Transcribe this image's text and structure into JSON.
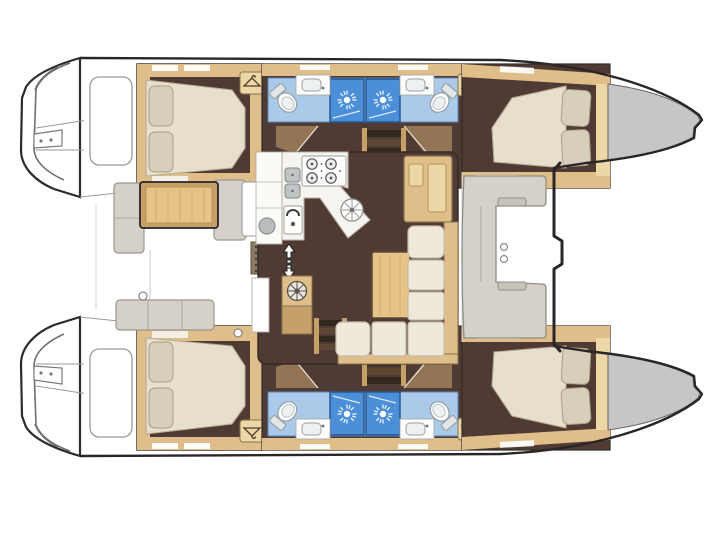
{
  "meta": {
    "title": "Catamaran sailing yacht interior layout floor plan, top-down view, bow to the right",
    "view": "top-down",
    "bow_direction": "right",
    "stern_direction": "left"
  },
  "colors": {
    "outline": "#2a2527",
    "hull_white": "#ffffff",
    "bow_deck_gray": "#c6c5c7",
    "cabin_floor_brown": "#4f3b33",
    "joinery_tan": "#dfbe8a",
    "joinery_light": "#ecd7a6",
    "joinery_dark": "#c5a068",
    "wood_table": "#e6c386",
    "upholstery_cream": "#efe9db",
    "mattress_cream": "#e7dfcc",
    "pillow_beige": "#d8cfba",
    "bathroom_floor_blue": "#abc9e8",
    "shower_blue": "#4b8fd8",
    "fixture_white": "#fdfdfb",
    "bench_gray": "#d5d1c9",
    "hatch_brown": "#8d7c64",
    "stair_dark": "#33281f",
    "stair_mid": "#5d4733",
    "transom_line": "#8a8a8a"
  },
  "layout": {
    "hulls": [
      {
        "name": "port-hull",
        "rooms": [
          "aft-double-cabin",
          "aft-bathroom-with-shower",
          "forward-bathroom-with-shower",
          "forward-double-cabin"
        ],
        "features": [
          "swim-platform-steps",
          "wardrobe-lockers",
          "bow-deck"
        ]
      },
      {
        "name": "starboard-hull",
        "rooms": [
          "aft-double-cabin",
          "aft-bathroom-with-shower",
          "forward-bathroom-with-shower",
          "forward-double-cabin"
        ],
        "features": [
          "swim-platform-steps",
          "wardrobe-lockers",
          "bow-deck"
        ]
      }
    ],
    "bridgedeck": {
      "aft_cockpit": [
        "cockpit-table",
        "bench-seats",
        "deck-hatch"
      ],
      "salon": [
        "galley-counters",
        "four-burner-stove",
        "double-sink",
        "oven",
        "round-sink",
        "companionway-arrows",
        "hull-stairs",
        "nav-desk",
        "dinette-table",
        "l-shaped-sofa"
      ],
      "forward_cockpit": [
        "c-shaped-lounge",
        "cupholders"
      ],
      "foredeck": [
        "crossbeam-line",
        "trampoline-area"
      ]
    }
  },
  "icons": [
    "shower-rose-icon",
    "clothes-hanger-icon",
    "toilet-icon",
    "sink-basin-icon",
    "double-sink-icon",
    "stove-burner-icon",
    "round-sink-icon",
    "oven-icon",
    "vent-fan-icon",
    "companionway-arrows-icon",
    "stairs-icon",
    "deck-hatch-icon",
    "cupholder-icon"
  ]
}
